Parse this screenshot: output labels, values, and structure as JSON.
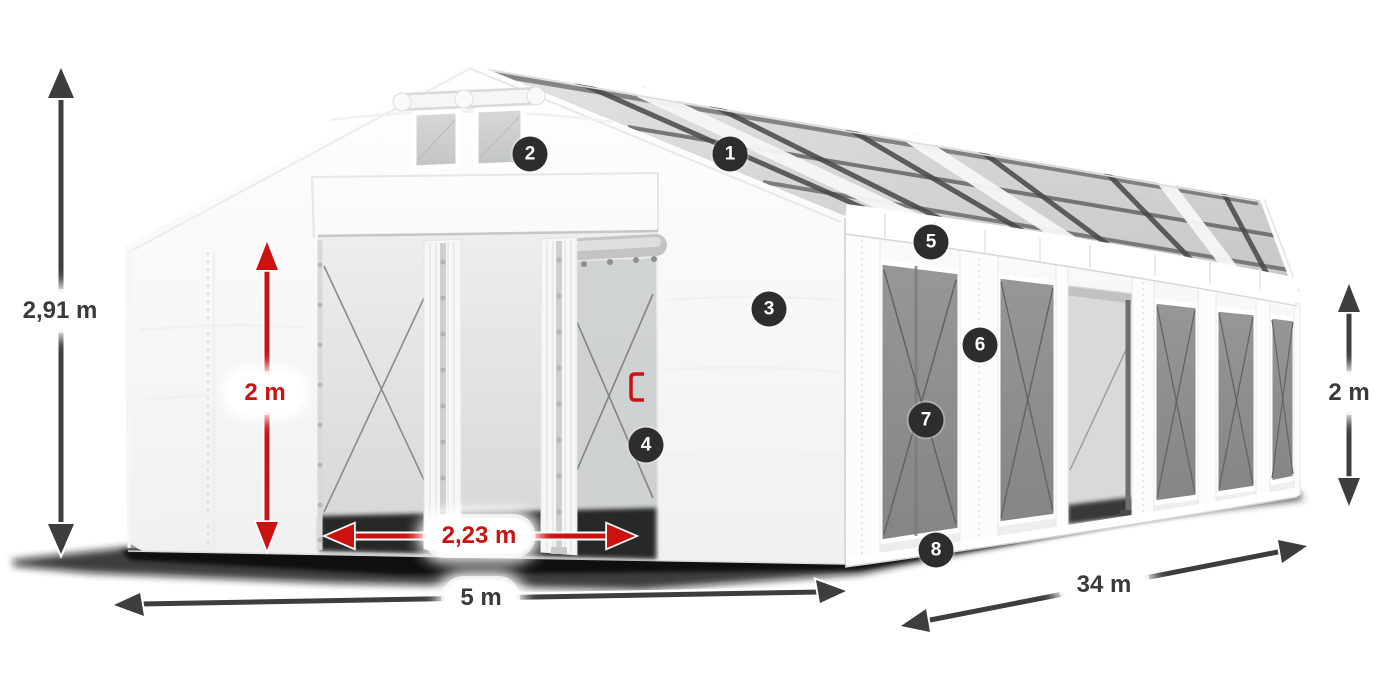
{
  "illustration": {
    "name": "storage-tent-3d-render",
    "description": "White PVC marquee tent with transparent roof panels, side windows with cross bracing and open front double doors, drawn in perspective with measurement arrows"
  },
  "colors": {
    "background": "#ffffff",
    "arrow_dark": "#3d3d3d",
    "arrow_red": "#cc1111",
    "badge_background": "#2d2d2d",
    "badge_text": "#ffffff",
    "pill_background": "#ffffff",
    "pill_text": "#3a3a3a",
    "window_gray": "#8e8e8e",
    "shadow": "#0b0b0b"
  },
  "dimensions": {
    "total_height": {
      "value": "2,91 m",
      "color": "dark",
      "orientation": "vertical"
    },
    "door_height": {
      "value": "2 m",
      "color": "red",
      "orientation": "vertical"
    },
    "door_width": {
      "value": "2,23 m",
      "color": "red",
      "orientation": "horizontal"
    },
    "front_width": {
      "value": "5 m",
      "color": "dark",
      "orientation": "horizontal"
    },
    "side_length": {
      "value": "34 m",
      "color": "dark",
      "orientation": "diagonal"
    },
    "side_height": {
      "value": "2 m",
      "color": "dark",
      "orientation": "vertical"
    }
  },
  "callouts": [
    {
      "number": "1"
    },
    {
      "number": "2"
    },
    {
      "number": "3"
    },
    {
      "number": "4"
    },
    {
      "number": "5"
    },
    {
      "number": "6"
    },
    {
      "number": "7"
    },
    {
      "number": "8"
    }
  ]
}
